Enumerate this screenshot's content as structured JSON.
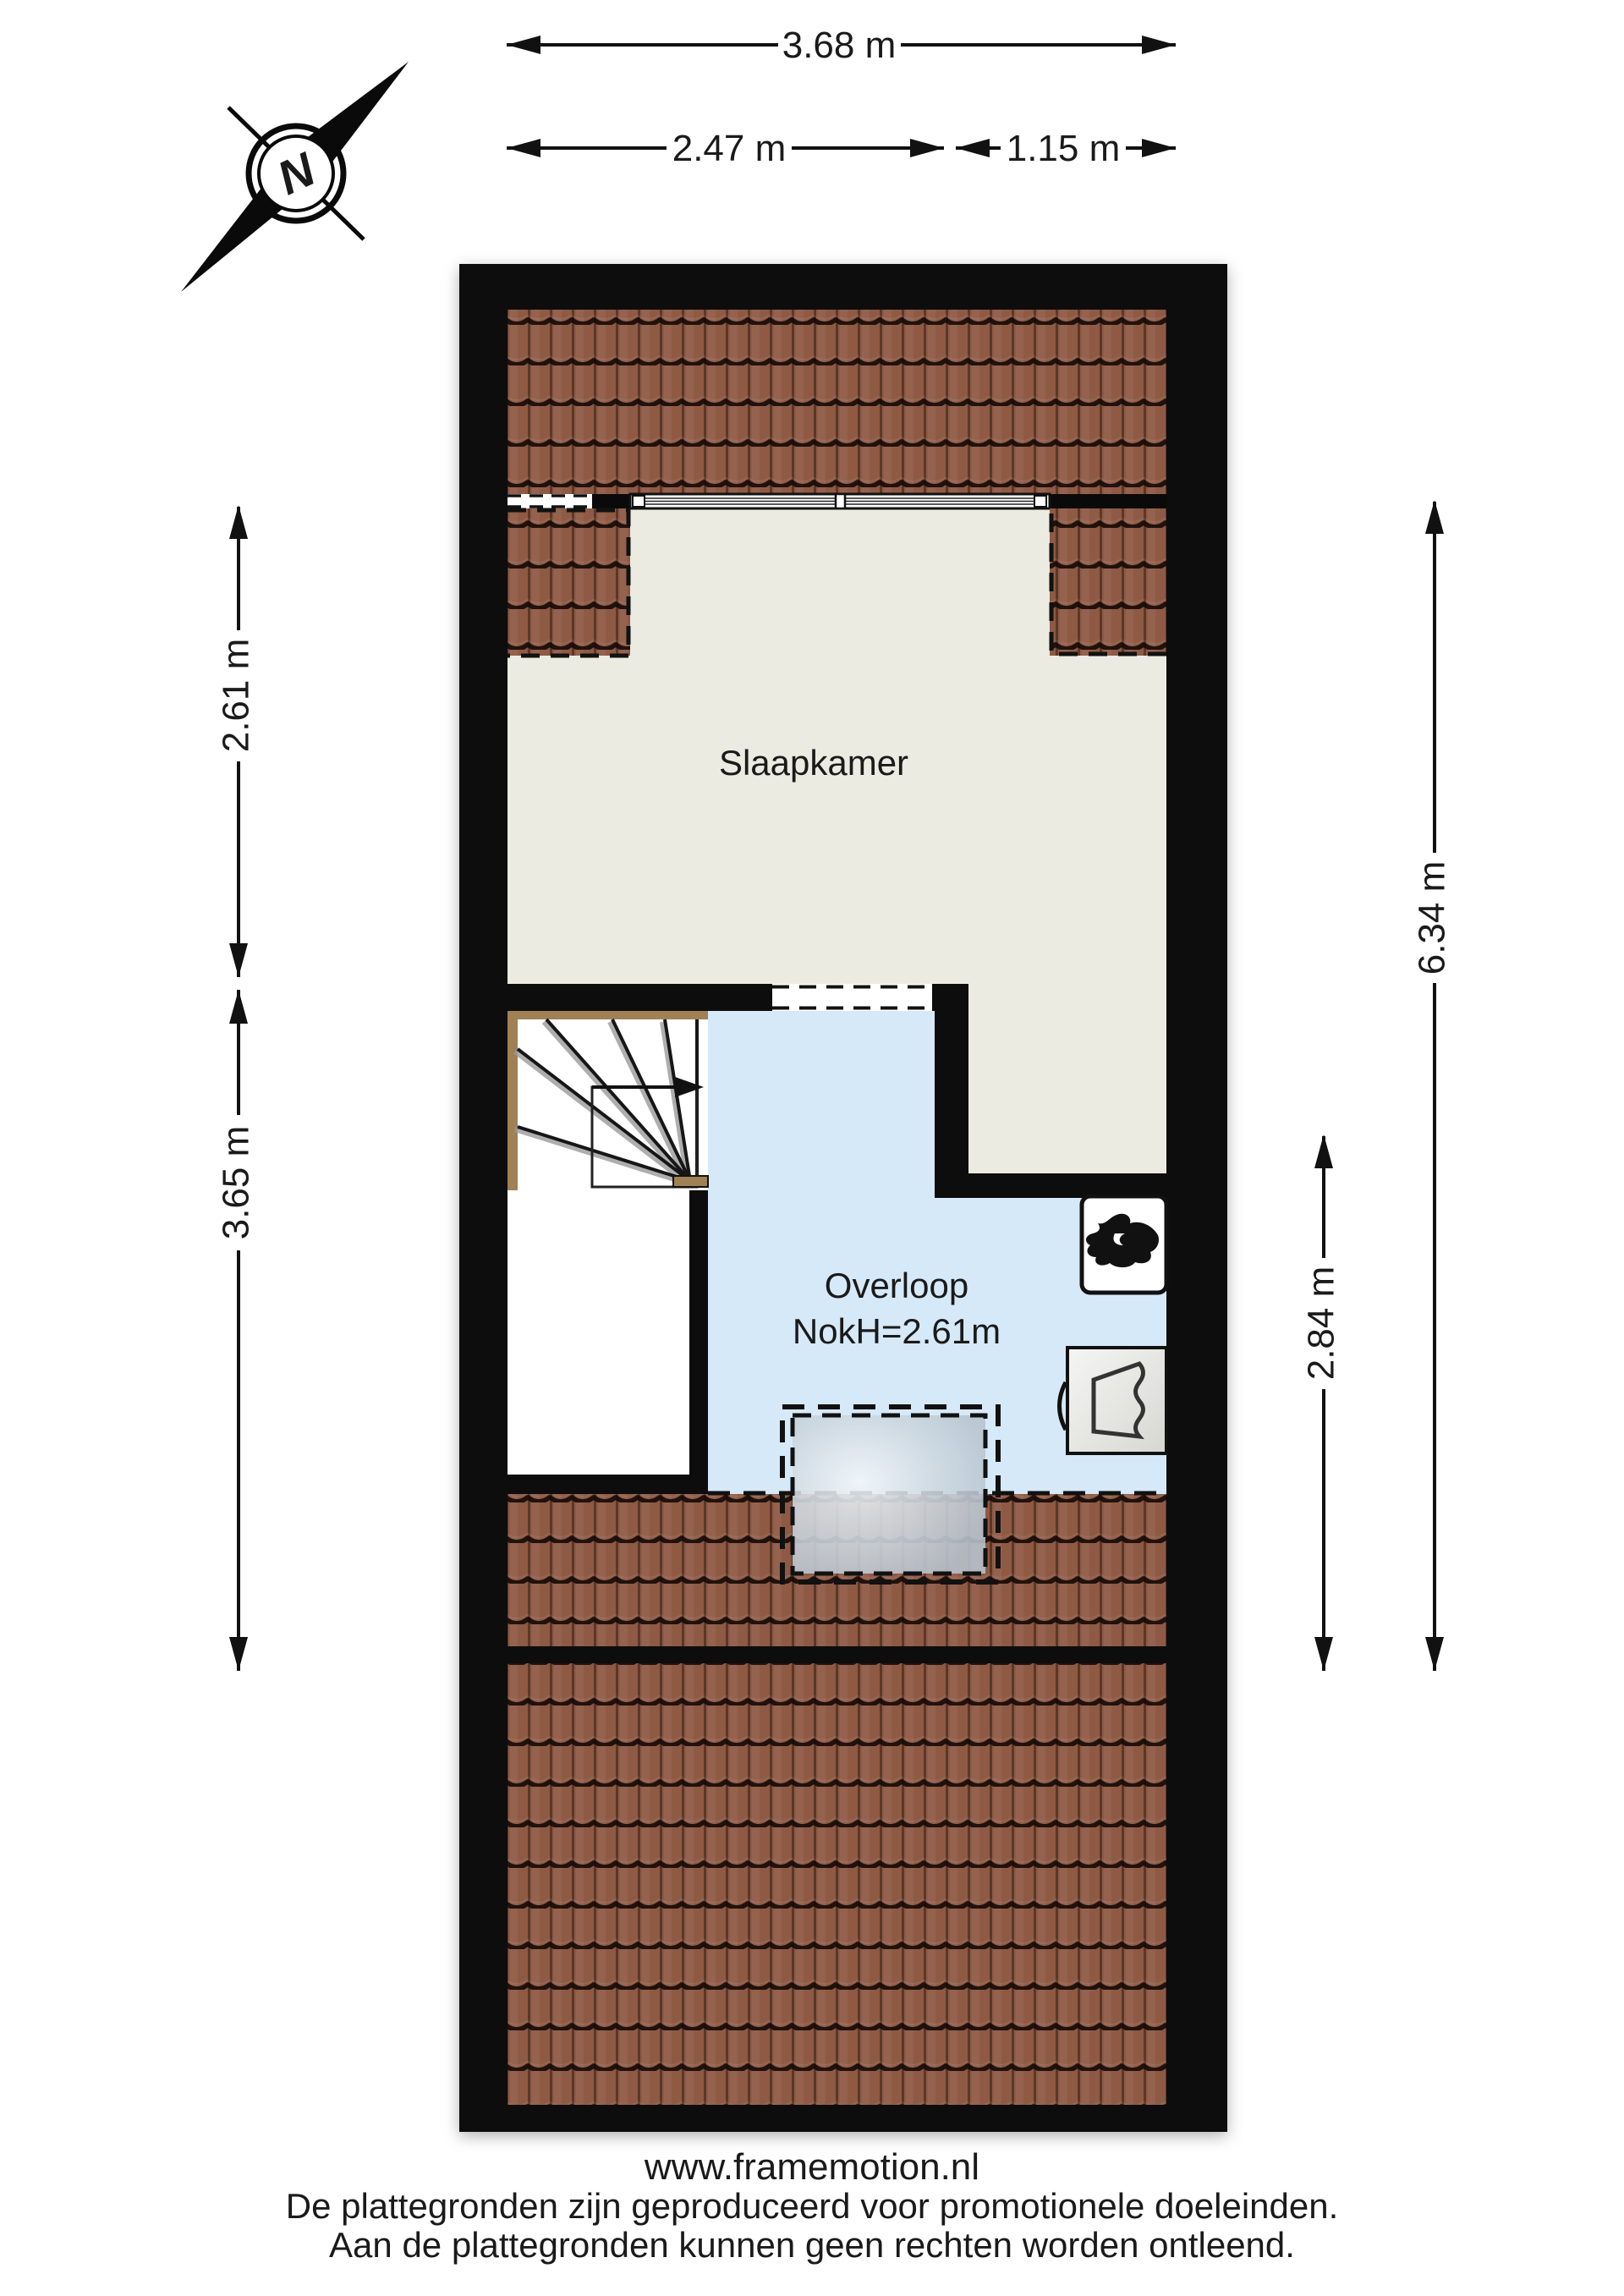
{
  "compass": {
    "north_label": "N"
  },
  "rooms": {
    "slaapkamer": {
      "label": "Slaapkamer"
    },
    "overloop": {
      "label": "Overloop",
      "ridge_height": "NokH=2.61m"
    }
  },
  "dimensions": {
    "top": [
      {
        "label": "3.68 m"
      },
      {
        "label": "2.47 m"
      },
      {
        "label": "1.15 m"
      }
    ],
    "left": [
      {
        "label": "2.61 m"
      },
      {
        "label": "3.65 m"
      }
    ],
    "right": [
      {
        "label": "6.34 m"
      },
      {
        "label": "2.84 m"
      }
    ]
  },
  "footer": {
    "website": "www.framemotion.nl",
    "disclaimer_line1": "De plattegronden zijn geproduceerd voor promotionele doeleinden.",
    "disclaimer_line2": "Aan de plattegronden kunnen geen rechten worden ontleend."
  },
  "colors": {
    "wall": "#0a0a0a",
    "roof_tile": "#8E5A44",
    "floor_gray": "#EBEBE2",
    "overloop_blue": "#D6E9F8",
    "stair_wood": "#A08055",
    "text": "#1a1a1a"
  }
}
